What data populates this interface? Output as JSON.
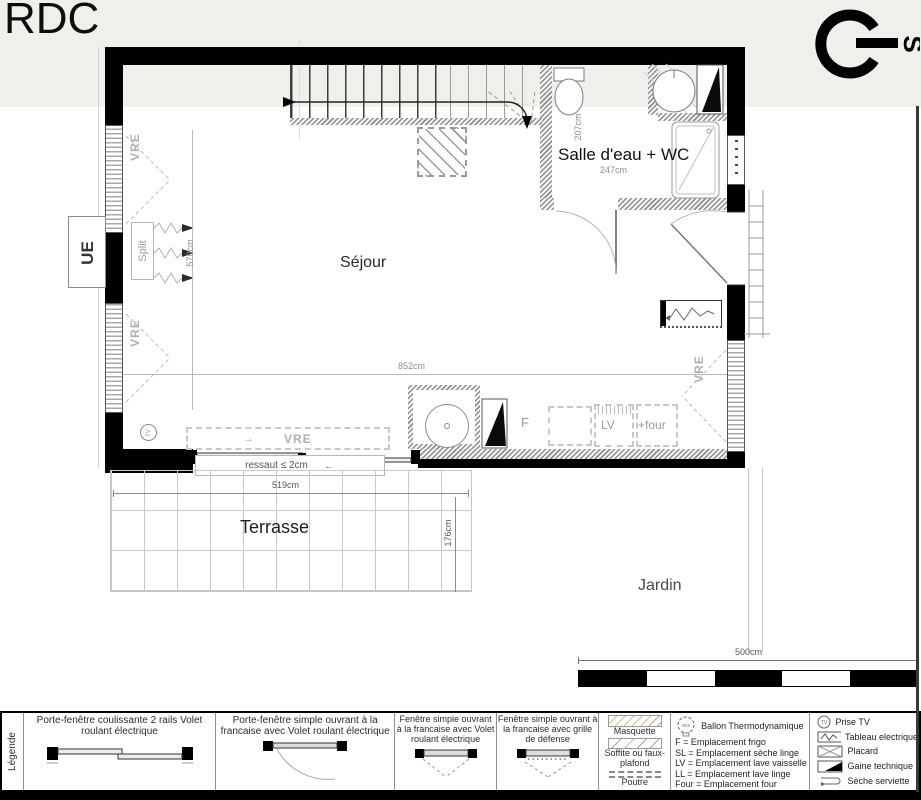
{
  "title": "RDC",
  "compass": {
    "south": "S"
  },
  "plan": {
    "rooms": {
      "sejour": "Séjour",
      "salle_eau": "Salle d'eau + WC",
      "terrasse": "Terrasse",
      "jardin": "Jardin"
    },
    "dimensions": {
      "sejour_width": "852cm",
      "sejour_height": "570cm",
      "salle_eau_width": "247cm",
      "salle_eau_height": "207cm",
      "terrasse_width": "519cm",
      "terrasse_height": "176cm",
      "ressaut": "ressaut ≤ 2cm",
      "scale_bar": "500cm"
    },
    "labels": {
      "vre": "VRE",
      "ue": "UE",
      "split": "Split",
      "frigo": "F",
      "lave_vaisselle": "LV",
      "four": "+four",
      "prise_tv": "TV",
      "arrow_left": "←",
      "arrow_right": "→"
    }
  },
  "legend": {
    "heading": "Légende",
    "openings": [
      {
        "label": "Porte-fenêtre coulissante 2 rails Volet roulant électrique"
      },
      {
        "label": "Porte-fenêtre simple ouvrant à la francaise avec Volet roulant électrique"
      },
      {
        "label": "Fenêtre simple ouvrant à la francaise avec Volet roulant électrique"
      },
      {
        "label": "Fenêtre simple ouvrant à la francaise avec grille de défense"
      }
    ],
    "surfaces": {
      "masquette": "Masquette",
      "soffite": "Soffite ou faux-plafond",
      "poutre": "Poutre"
    },
    "ballon": "Ballon Thermodynamique",
    "ballon_icon_text": "ecs",
    "codes": [
      "F    = Emplacement frigo",
      "SL = Emplacement sèche linge",
      "LV = Emplacement lave vaisselle",
      "LL = Emplacement lave linge",
      "Four = Emplacement four"
    ],
    "symbols": [
      "Prise TV",
      "Tableau electrique",
      "Placard",
      "Gaine technique",
      "Sèche serviette"
    ]
  }
}
